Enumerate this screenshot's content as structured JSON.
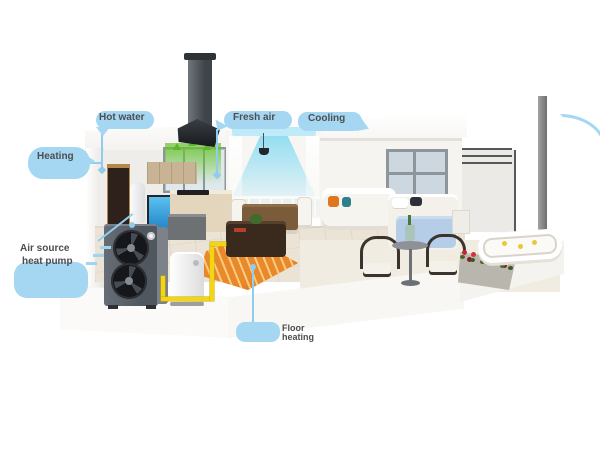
{
  "illustration": {
    "description": "3D cutaway rendering of a house equipped with an air source heat pump system (outdoor unit, buffer tank, underfloor heating, ventilation and cooling airflow)",
    "background": "#ffffff"
  },
  "callouts": {
    "hot_water": {
      "label": "Hot water"
    },
    "fresh_air": {
      "label": "Fresh air"
    },
    "cooling": {
      "label": "Cooling"
    },
    "heating": {
      "label": "Heating"
    },
    "heat_pump": {
      "line1": "Air source",
      "line2": "heat pump"
    },
    "floor_heating": {
      "label": "Floor heating"
    }
  },
  "colors": {
    "callout_bubble": "#a5d7f2",
    "callout_text": "#4d4d50",
    "connector_line": "#8fcdee",
    "pipe_yellow": "#f3d512",
    "floor_heating_orange": "#e8892b",
    "fresh_air_green": "#5bb52e",
    "cool_air_cyan": "#aee6f5",
    "outdoor_unit_gray": "#596069"
  }
}
